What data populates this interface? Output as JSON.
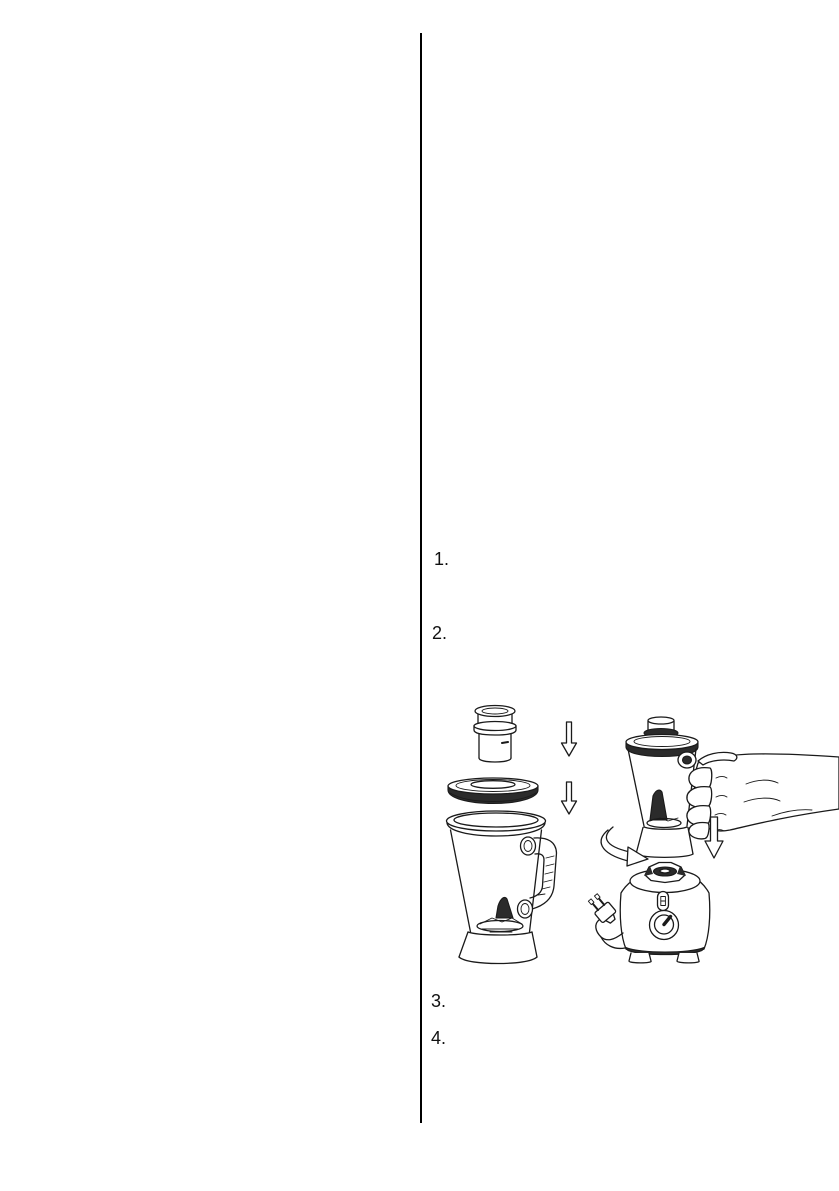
{
  "page": {
    "background": "#ffffff",
    "divider_color": "#000000"
  },
  "steps": [
    {
      "marker": "1."
    },
    {
      "marker": "2."
    },
    {
      "marker": "3."
    },
    {
      "marker": "4."
    }
  ],
  "figure": {
    "line_color": "#1a1a1a",
    "description": "Blender assembly diagram: measuring cup, lid and jar exploded with down arrows; a hand lowers the assembled jar onto the motor base with power plug",
    "parts": [
      "measuring-cup",
      "jar-lid",
      "blender-jar",
      "down-arrow",
      "assembled-jar",
      "hand-holding-jar",
      "curved-arrow",
      "motor-base",
      "power-plug"
    ]
  }
}
